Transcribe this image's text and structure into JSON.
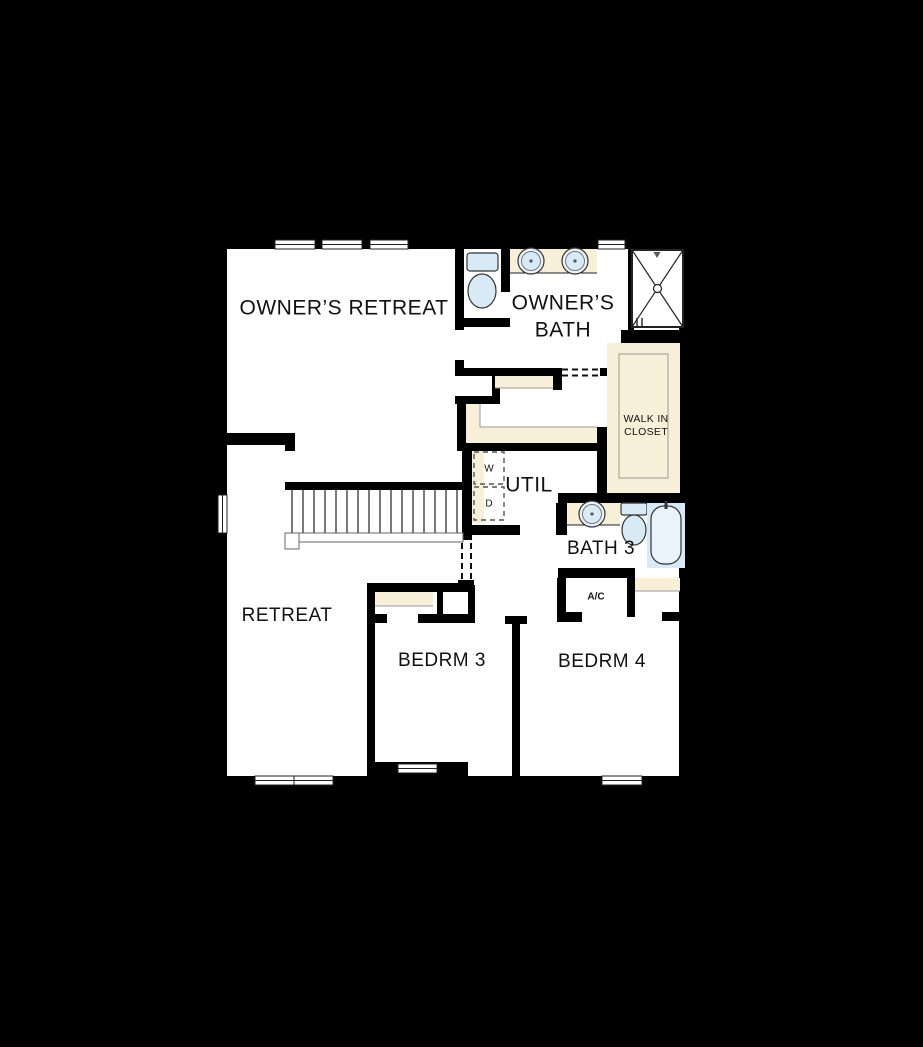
{
  "floor_plan": {
    "rooms": {
      "owners_retreat": {
        "label": "OWNER’S RETREAT"
      },
      "owners_bath": {
        "label_line1": "OWNER’S",
        "label_line2": "BATH"
      },
      "walk_in_closet": {
        "label_line1": "WALK IN",
        "label_line2": "CLOSET"
      },
      "util": {
        "label": "UTIL"
      },
      "bath3": {
        "label": "BATH 3"
      },
      "ac_closet": {
        "label": "A/C"
      },
      "retreat": {
        "label": "RETREAT"
      },
      "bedroom3": {
        "label": "BEDRM 3"
      },
      "bedroom4": {
        "label": "BEDRM 4"
      }
    },
    "appliances": {
      "washer_label": "W",
      "dryer_label": "D"
    },
    "colors": {
      "background": "#000000",
      "floor": "#ffffff",
      "walls": "#000000",
      "shelving": "#f8efd8",
      "fixtures": "#d9eaf7"
    }
  }
}
